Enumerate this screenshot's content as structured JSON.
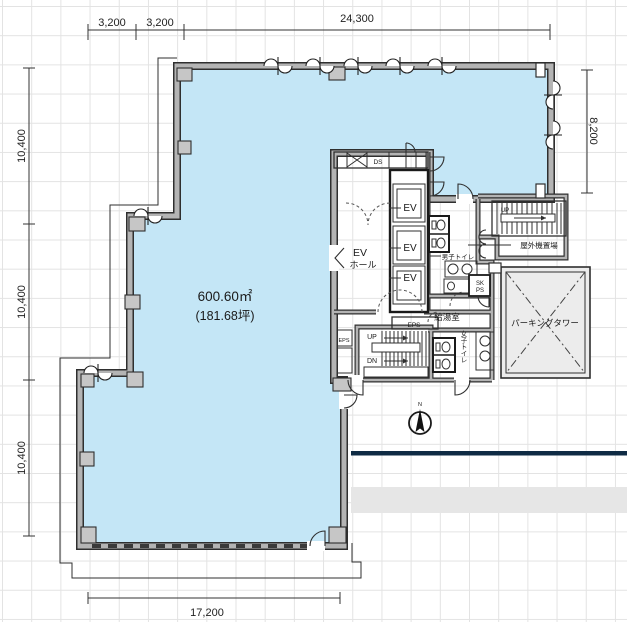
{
  "drawing": {
    "area": {
      "sqm": "600.60㎡",
      "tsubo": "(181.68坪)"
    },
    "dimensions": {
      "top_left_a": "3,200",
      "top_left_b": "3,200",
      "top_width": "24,300",
      "left_upper": "10,400",
      "left_middle": "10,400",
      "left_lower": "10,400",
      "right_height": "8,200",
      "bottom_width": "17,200"
    },
    "labels": {
      "ev_hall_l1": "EV",
      "ev_hall_l2": "ホール",
      "ev1": "EV",
      "ev2": "EV",
      "ev3": "EV",
      "ds": "DS",
      "eps_core": "EPS",
      "eps_shaft": "EPS",
      "sk": "SK",
      "ps": "PS",
      "mens_toilet": "男子トイレ",
      "womens_toilet": "女子トイレ",
      "kitchenette": "給湯室",
      "outdoor_unit_area": "屋外機置場",
      "parking_tower": "パーキングタワー",
      "stair_up": "UP",
      "stair_dn": "DN",
      "outdoor_stair_up": "UP",
      "compass_north": "N"
    },
    "colors": {
      "room_fill": "#c4e6f6",
      "wall": "#b4b4b4",
      "navy_line": "#0f2b44",
      "site_band": "#e6e6e6",
      "parking_fill": "#ececec",
      "column": "#c6c6c6"
    }
  }
}
